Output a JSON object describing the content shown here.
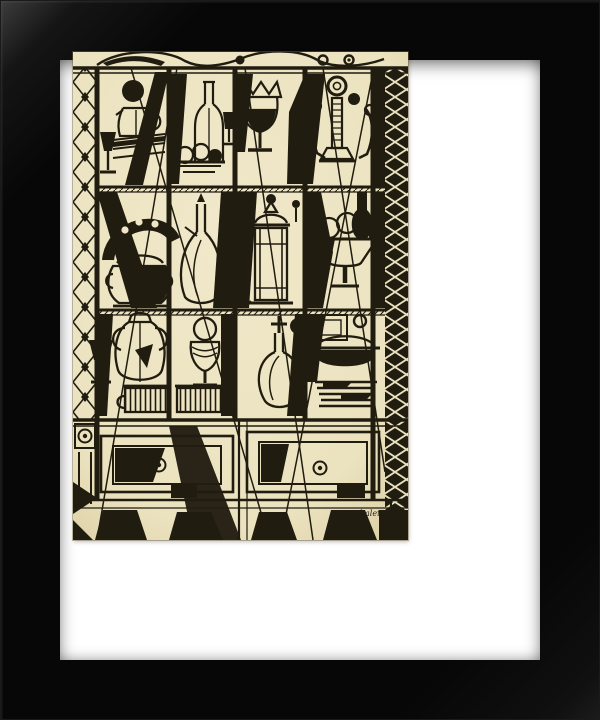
{
  "artwork": {
    "signature": "R.Zabaleta",
    "alt": "Black ink cubist still-life drawing of a tall glass cabinet filled with pitchers, bottles, goblets, a crowned cup, a candlestick, a fruit compote, urns and covered dishes, standing on a table with panelled front and dark tapered legs, in a black gallery frame with a white mat",
    "frame_type": "black gallery frame",
    "mat_type": "white mat"
  },
  "colors": {
    "frame": "#070707",
    "frame_highlight": "#3d3d3d",
    "mat": "#ffffff",
    "paper": "#f0e8c9",
    "paper_edge": "#d8cb9e",
    "ink": "#201c10"
  }
}
